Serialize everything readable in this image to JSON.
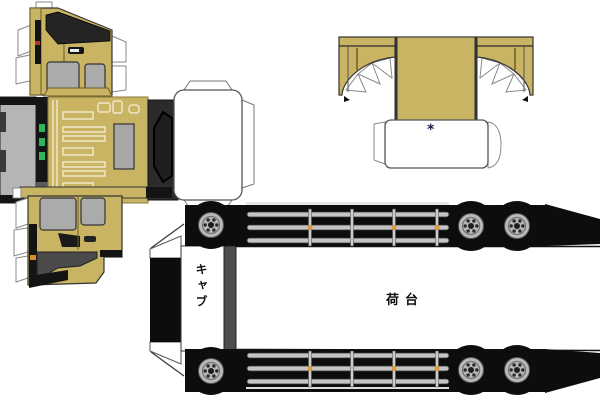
{
  "document": {
    "kind": "papercraft-truck-template-sheet"
  },
  "labels": {
    "cab": "キャブ",
    "cargo_bed": "荷台",
    "roof_mark": "*"
  },
  "palette": {
    "body_tan": "#c9b464",
    "body_tan_dark": "#8a7a3a",
    "grille_cream": "#efe8c8",
    "window_gray": "#ababab",
    "rear_panel_gray": "#b5b5b5",
    "bumper_gray": "#4a4a4a",
    "ink_black": "#111111",
    "green_marker_light": "#2fb457",
    "amber_marker_light": "#e09a3e",
    "red_marker_light": "#b23327",
    "rail_silver": "#c4c4c4",
    "paper_white": "#ffffff",
    "outline_gray": "#555555"
  },
  "pieces": [
    {
      "name": "cab-side-panel-right"
    },
    {
      "name": "cab-front-unfold-strip"
    },
    {
      "name": "cab-side-panel-left"
    },
    {
      "name": "roof-wind-deflector"
    },
    {
      "name": "chassis-top-view"
    }
  ]
}
